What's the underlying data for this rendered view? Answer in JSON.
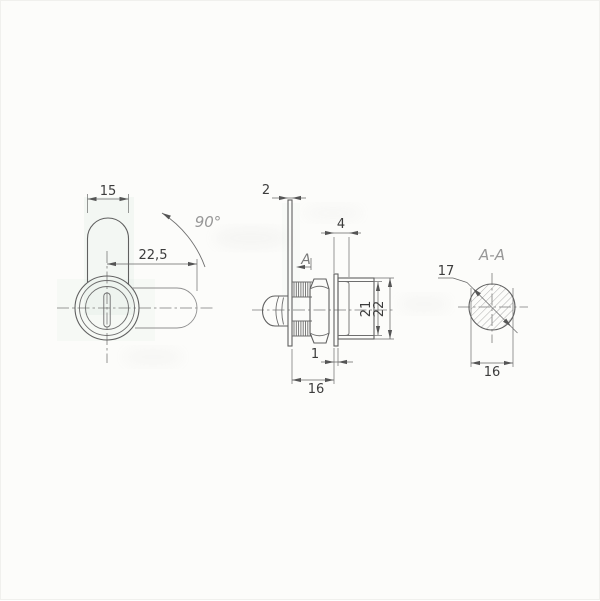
{
  "colors": {
    "background": "#fcfcfa",
    "line": "#606060",
    "dimension_text": "#3c3c3c",
    "muted_label": "#979797",
    "hatch": "#9a9a9a"
  },
  "front_view": {
    "cam_width": "15",
    "cam_travel": "22,5",
    "rotation_angle": "90°"
  },
  "side_view": {
    "cam_thickness": "2",
    "thread_length": "4",
    "section_label": "A",
    "inner_height": "21",
    "body_height": "22",
    "flange_thickness": "1",
    "body_length": "16"
  },
  "section_view": {
    "title": "A-A",
    "diameter": "17",
    "across_flats": "16"
  }
}
